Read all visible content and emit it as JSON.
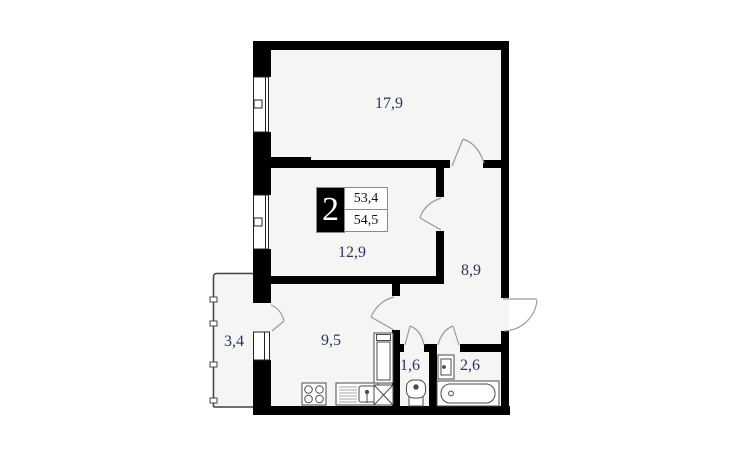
{
  "plan": {
    "title": "two-room apartment floor plan",
    "info": {
      "room_count": "2",
      "living_area": "53,4",
      "total_area": "54,5"
    },
    "rooms": [
      {
        "name": "living-room",
        "label": "17,9"
      },
      {
        "name": "bedroom",
        "label": "12,9"
      },
      {
        "name": "hallway",
        "label": "8,9"
      },
      {
        "name": "kitchen",
        "label": "9,5"
      },
      {
        "name": "balcony",
        "label": "3,4"
      },
      {
        "name": "wc",
        "label": "1,6"
      },
      {
        "name": "bathroom",
        "label": "2,6"
      }
    ],
    "colors": {
      "wall": "#000000",
      "floor": "#f5f5f3",
      "label_text": "#2a3560",
      "fixture_line": "#4a4a4a",
      "door_arc": "#9a9a9a"
    }
  }
}
